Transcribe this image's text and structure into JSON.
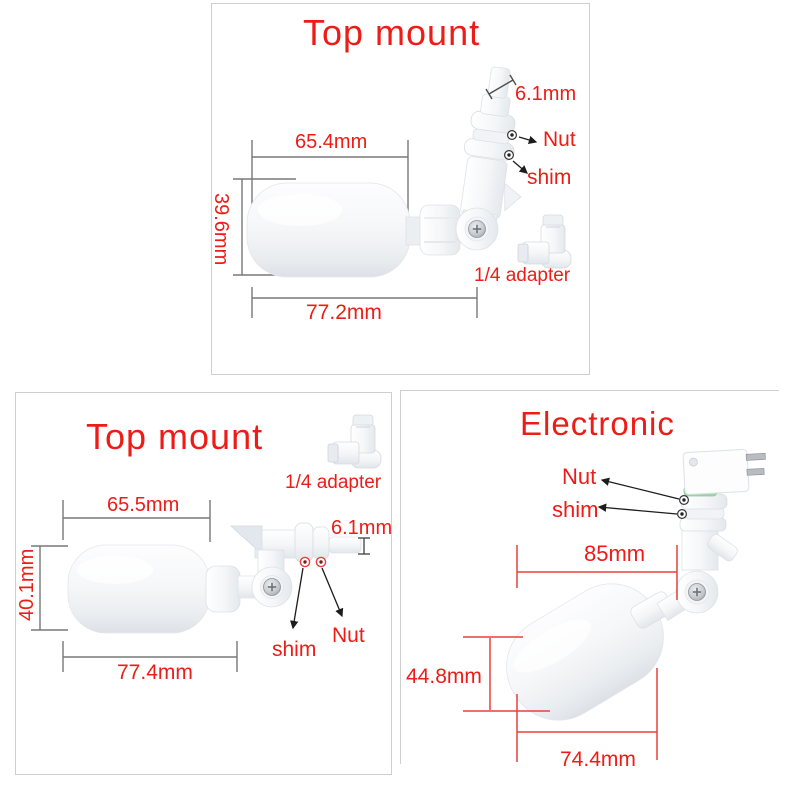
{
  "colors": {
    "accent_red": "#ee1c16",
    "dim_line_gray": "#787878",
    "dim_line_red": "#e8413c",
    "panel_border": "#cfcfcf",
    "seal_green": "#a0d8ab"
  },
  "panels": {
    "p1": {
      "title": "Top mount",
      "dims": {
        "width_top": "65.4mm",
        "height_left": "39.6mm",
        "width_bottom": "77.2mm",
        "outlet": "6.1mm"
      },
      "parts": {
        "nut": "Nut",
        "shim": "shim",
        "adapter": "1/4 adapter"
      }
    },
    "p2": {
      "title": "Top mount",
      "dims": {
        "width_top": "65.5mm",
        "height_left": "40.1mm",
        "width_bottom": "77.4mm",
        "outlet": "6.1mm"
      },
      "parts": {
        "nut": "Nut",
        "shim": "shim",
        "adapter": "1/4 adapter"
      }
    },
    "p3": {
      "title": "Electronic",
      "dims": {
        "width_top": "85mm",
        "height_left": "44.8mm",
        "width_bottom": "74.4mm"
      },
      "parts": {
        "nut": "Nut",
        "shim": "shim"
      }
    }
  }
}
